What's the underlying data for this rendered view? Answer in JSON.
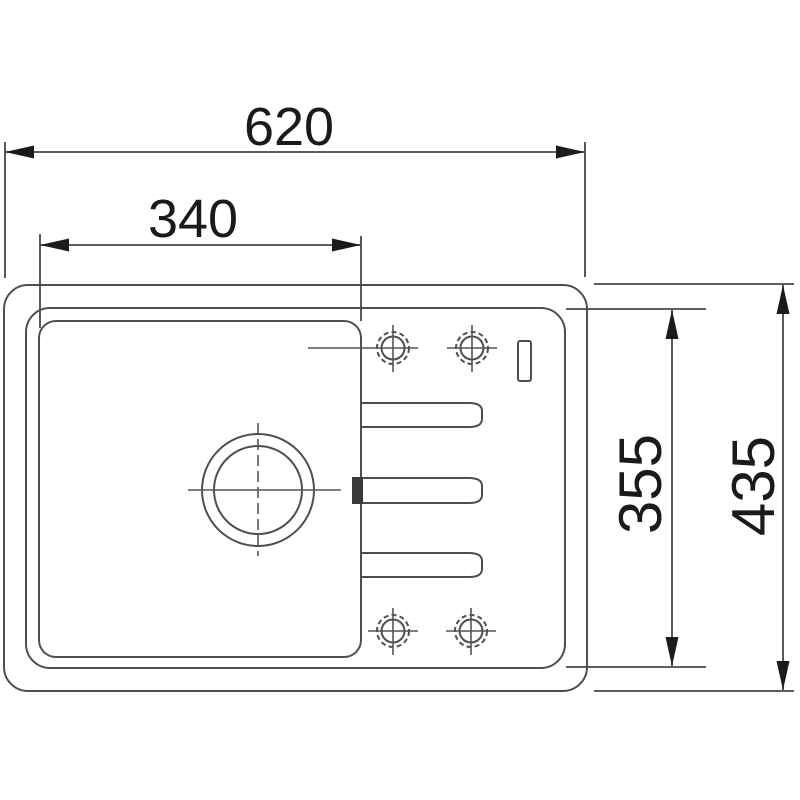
{
  "drawing": {
    "description": "sink-top-view-dimension-drawing",
    "colors": {
      "background": "#ffffff",
      "line": "#4f4f4f",
      "ink": "#1a1a1a"
    },
    "labels": {
      "overall_width": "620",
      "bowl_width": "340",
      "inner_depth": "355",
      "overall_depth": "435"
    }
  }
}
